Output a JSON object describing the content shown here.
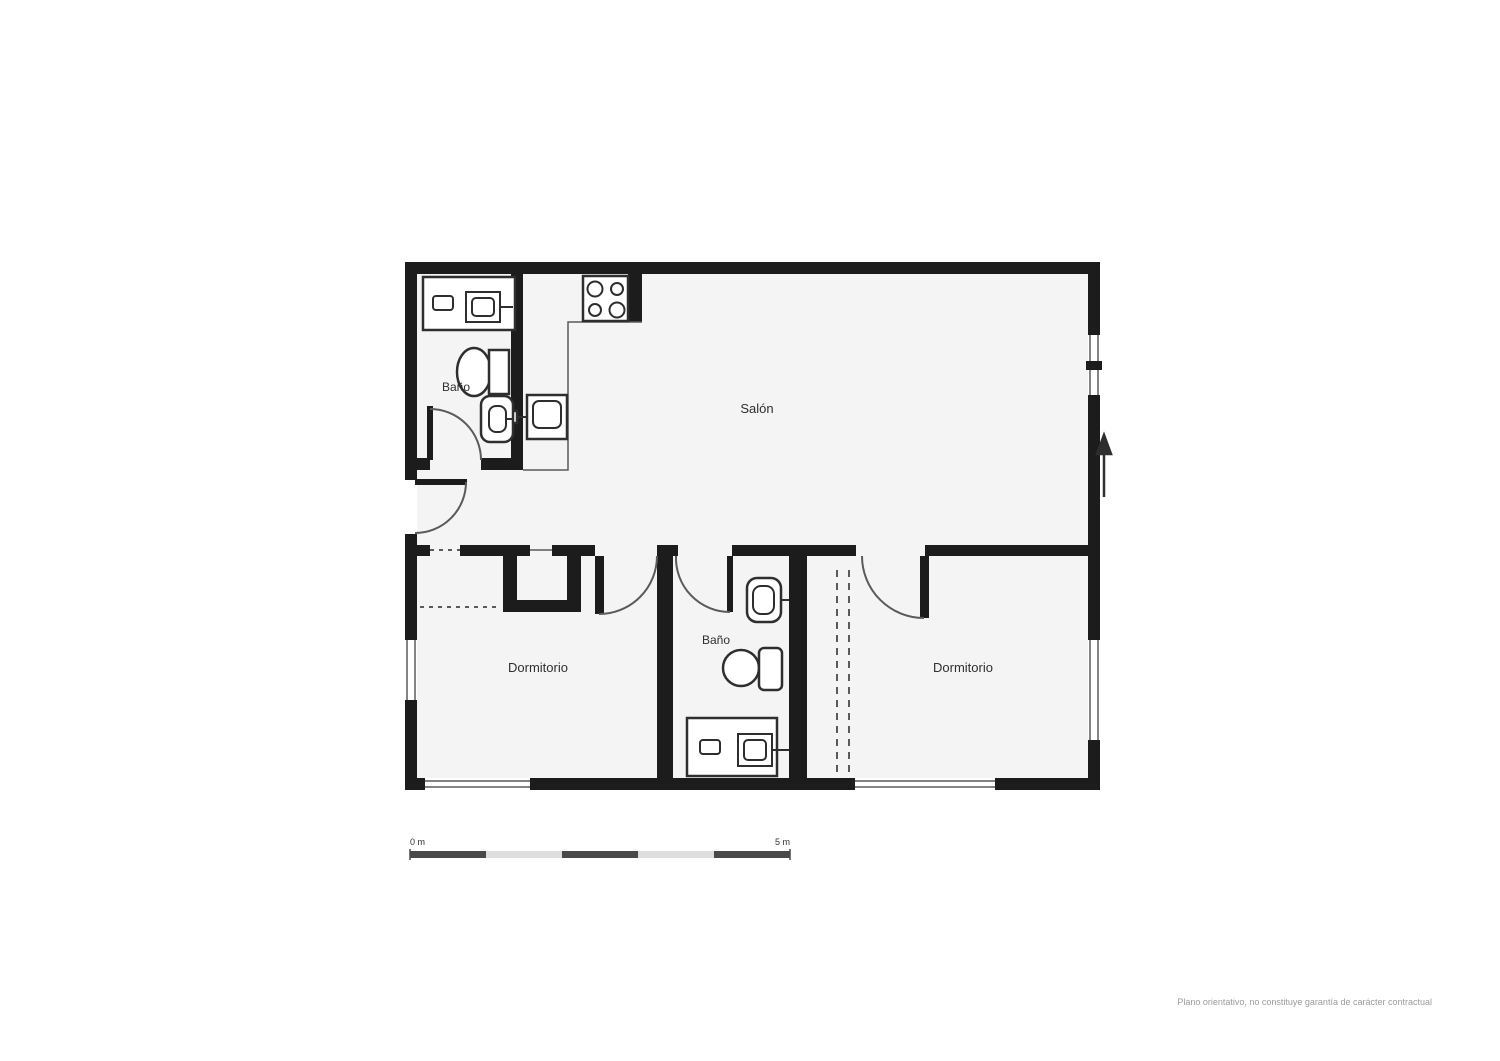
{
  "colors": {
    "wall": "#1c1c1c",
    "room_fill": "#f4f4f4",
    "line": "#5a5a5a",
    "fixture": "#2e2e2e",
    "scale_dark": "#4a4a4a",
    "scale_light": "#dedede",
    "text": "#2f2f2f",
    "disclaimer": "#9b9b9b"
  },
  "icons": {
    "entrance_arrow": "up-arrow",
    "stove": "four-burner-cooktop",
    "scale_bar": "alternating-5-segment-bar"
  },
  "rooms": {
    "salon": "Salón",
    "bano_top": "Baño",
    "dormitorio_left": "Dormitorio",
    "bano_middle": "Baño",
    "dormitorio_right": "Dormitorio"
  },
  "scale_bar": {
    "start_label": "0 m",
    "end_label": "5 m"
  },
  "footer": {
    "disclaimer": "Plano orientativo, no constituye garantía de carácter contractual"
  }
}
